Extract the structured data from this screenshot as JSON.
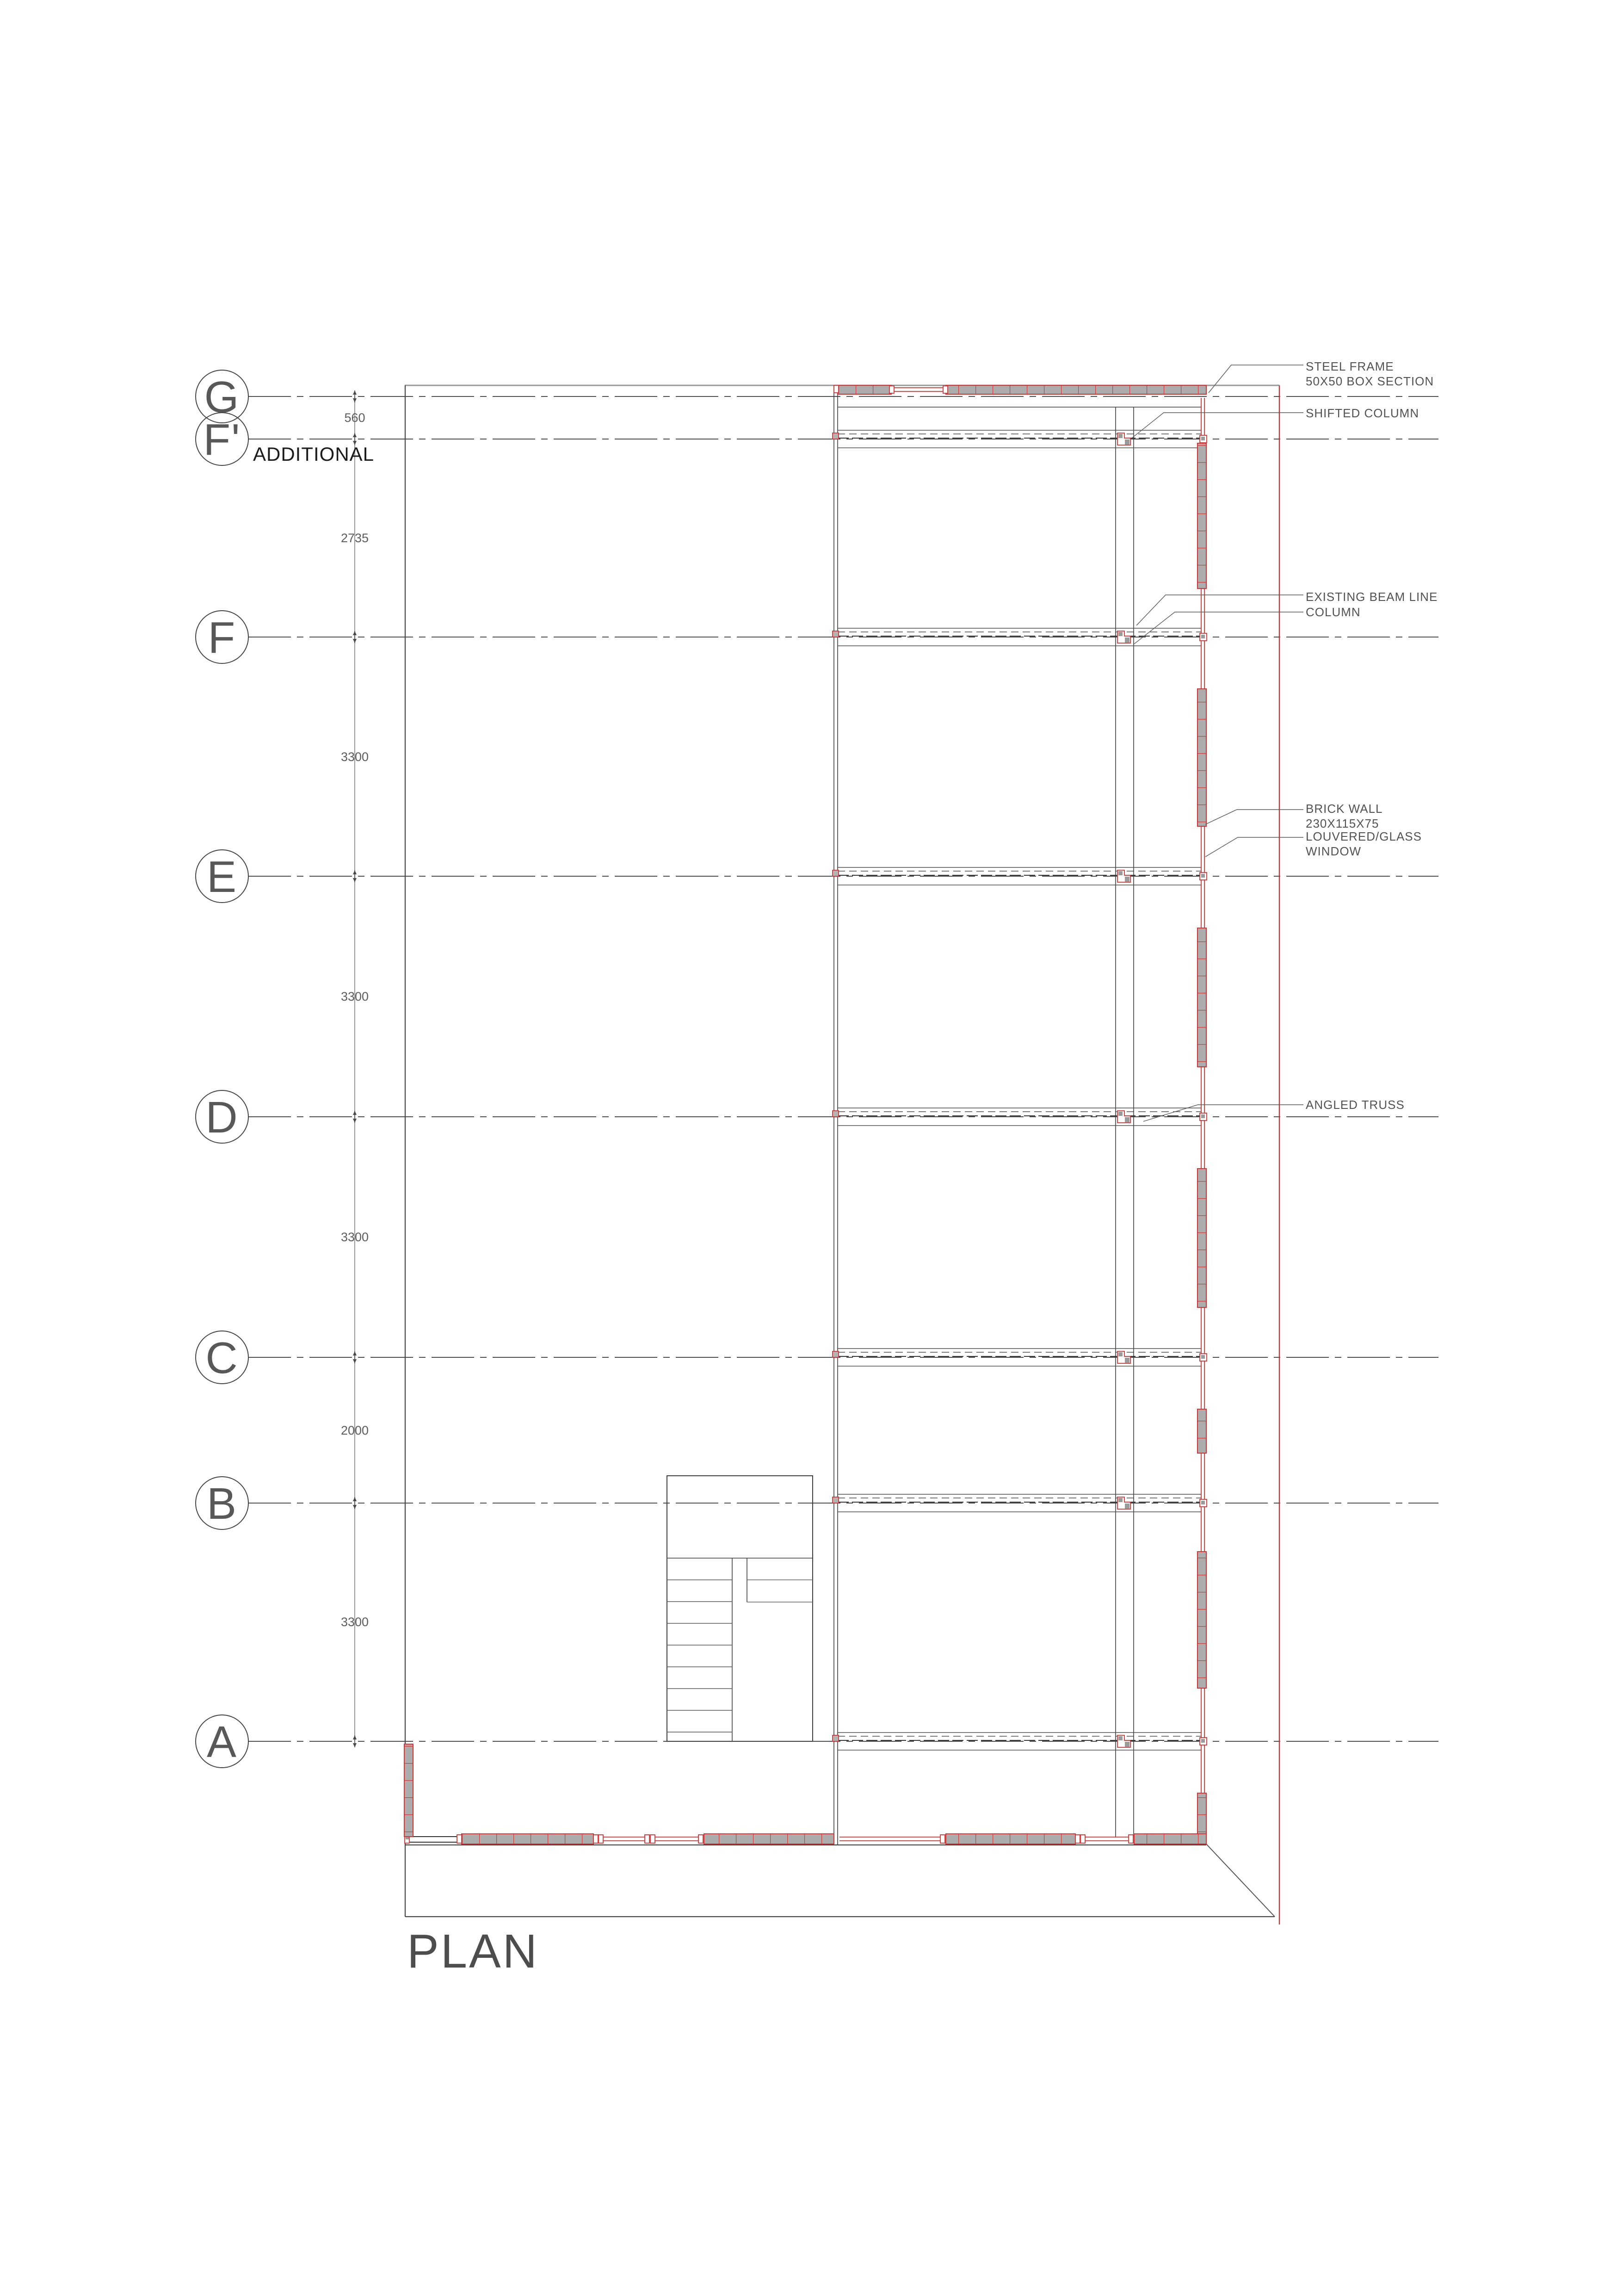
{
  "drawing": {
    "title": "PLAN",
    "additional_label": "ADDITIONAL"
  },
  "grid": {
    "rows": [
      {
        "label": "G",
        "dim_after": "560"
      },
      {
        "label": "F'",
        "dim_after": "2735"
      },
      {
        "label": "F",
        "dim_after": "3300"
      },
      {
        "label": "E",
        "dim_after": "3300"
      },
      {
        "label": "D",
        "dim_after": "3300"
      },
      {
        "label": "C",
        "dim_after": "2000"
      },
      {
        "label": "B",
        "dim_after": "3300"
      },
      {
        "label": "A",
        "dim_after": ""
      }
    ]
  },
  "annotations": {
    "steel_frame": {
      "lines": [
        "STEEL FRAME",
        "50X50 BOX SECTION"
      ]
    },
    "shifted_column": {
      "label": "SHIFTED COLUMN"
    },
    "existing_beam_line": {
      "label": "EXISTING BEAM LINE"
    },
    "column": {
      "label": "COLUMN"
    },
    "brick_wall": {
      "lines": [
        "BRICK WALL",
        "230X115X75"
      ]
    },
    "louvered_window": {
      "lines": [
        "LOUVERED/GLASS",
        "WINDOW"
      ]
    },
    "angled_truss": {
      "label": "ANGLED TRUSS"
    }
  },
  "colors": {
    "wall_red": "#d63434",
    "hatch_gray": "#acacac",
    "boundary_red": "#c43a3a",
    "line_dark": "#3f3f3f",
    "grid_line": "#4f4f4f",
    "annotation_text": "#525252",
    "additional_text": "#1b1b1b",
    "title_text": "#4d4d4d",
    "dimension_text": "#5d5d5d"
  }
}
